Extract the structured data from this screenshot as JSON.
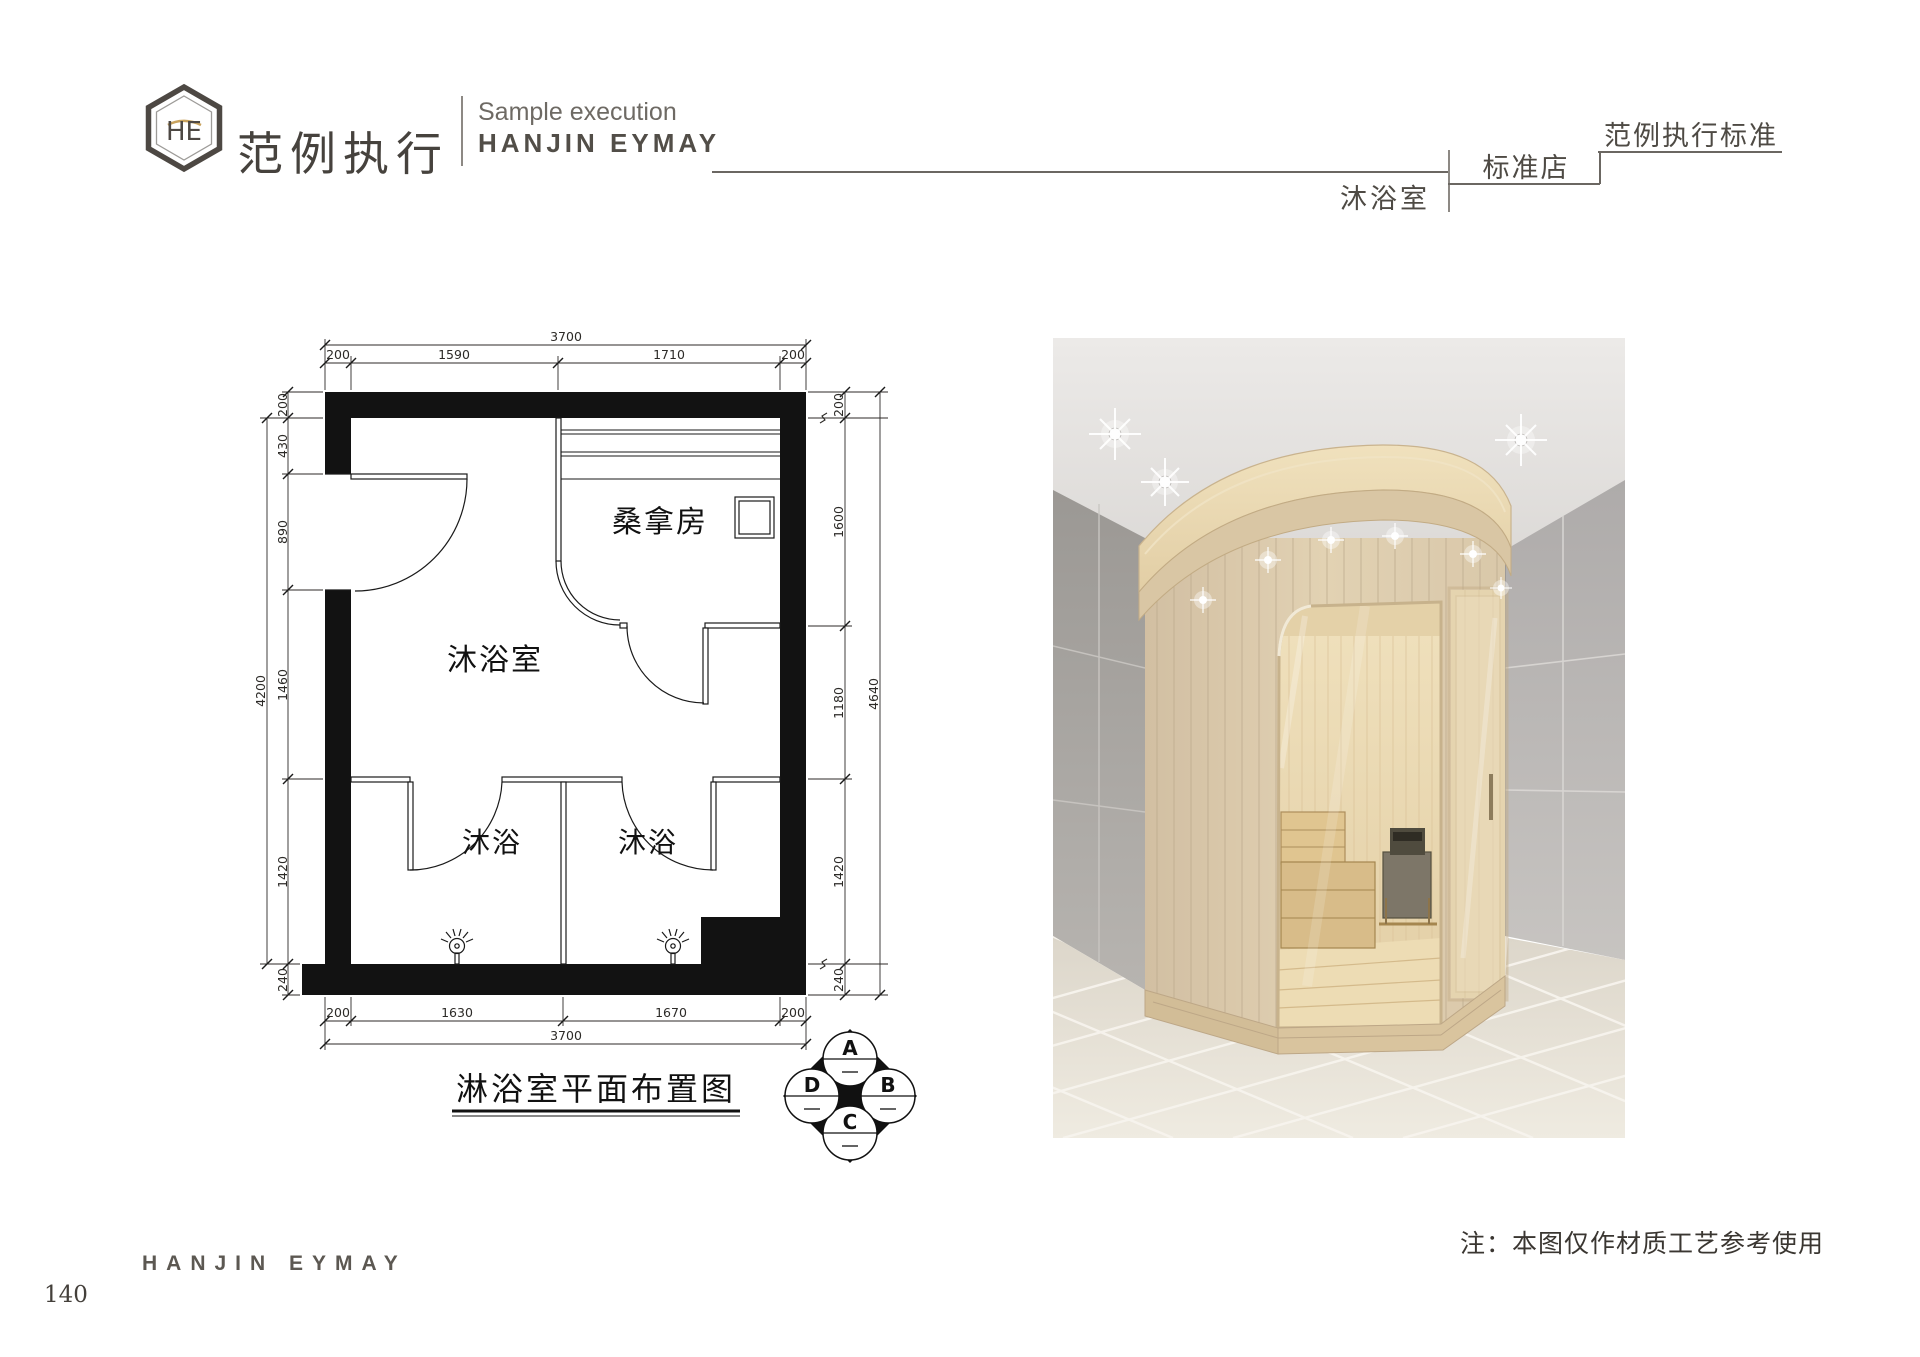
{
  "header": {
    "brand_cn": "范例执行",
    "brand_sub": "Sample execution",
    "brand_en": "HANJIN EYMAY",
    "standard": "范例执行标准",
    "store_type": "标准店",
    "room": "沐浴室"
  },
  "plan": {
    "title": "淋浴室平面布置图",
    "rooms": {
      "sauna": "桑拿房",
      "main": "沐浴室",
      "stall_left": "沐浴",
      "stall_right": "沐浴"
    },
    "dims": {
      "top_total": "3700",
      "top": [
        "200",
        "1590",
        "1710",
        "200"
      ],
      "left_total": "4200",
      "left": [
        "200",
        "430",
        "890",
        "1460",
        "1420",
        "240"
      ],
      "right_total": "4640",
      "right": [
        "200",
        "1600",
        "1180",
        "1420",
        "240"
      ],
      "bottom": [
        "200",
        "1630",
        "1670",
        "200"
      ],
      "bottom_total": "3700"
    },
    "marker": {
      "top": "A",
      "right": "B",
      "bottom": "C",
      "left": "D"
    }
  },
  "note": "注：本图仅作材质工艺参考使用",
  "footer": {
    "brand": "HANJIN EYMAY",
    "page": "140"
  }
}
